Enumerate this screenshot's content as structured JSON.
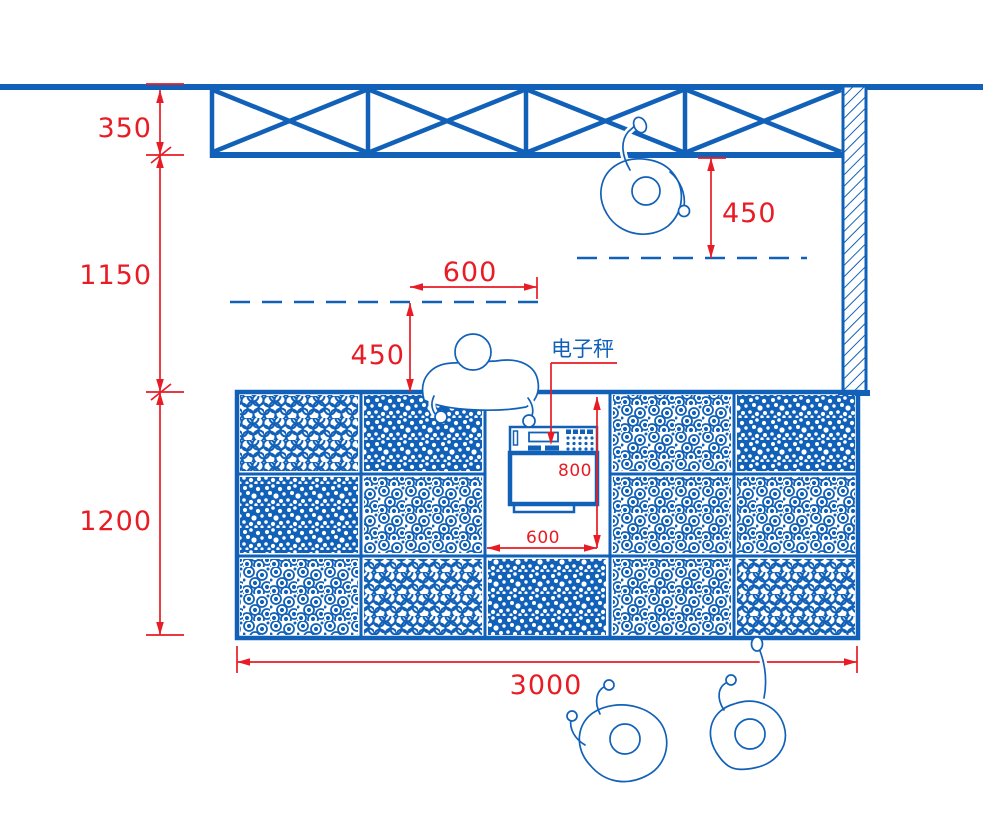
{
  "drawing": {
    "colors": {
      "line": "#1261b8",
      "dimension": "#e81c24",
      "background": "#ffffff"
    },
    "scale_label": "电子秤",
    "dimensions": {
      "wall_to_shelf": "350",
      "shelf_to_counter": "1150",
      "counter_depth": "1200",
      "shelf_reach_clearance": "450",
      "queue_width": "600",
      "counter_reach_clearance": "450",
      "scale_bay_depth": "800",
      "scale_bay_width": "600",
      "counter_length": "3000"
    },
    "figures": {
      "people_count": 4,
      "bin_rows": 3,
      "bin_columns": 5
    }
  }
}
